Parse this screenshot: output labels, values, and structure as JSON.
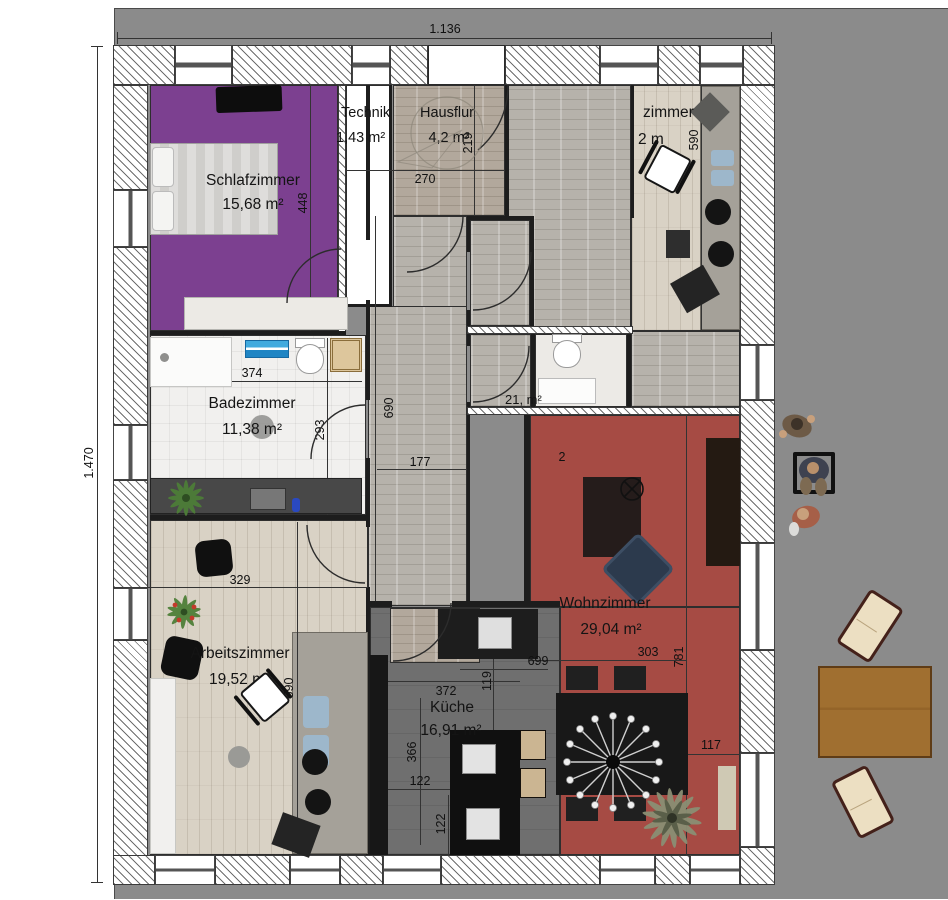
{
  "meta": {
    "width_label": "1.136",
    "height_label": "1.470"
  },
  "palette": {
    "bedroom_purple": "#7c4090",
    "living_red": "#a64b44",
    "outdoor_gray": "#8b8b8b",
    "wood_light": "#d9d2c5",
    "stone_gray": "#b6b2ab",
    "kitchen_floor": "#6f6f6f",
    "counter_black": "#161616",
    "chair_blue": "#9db7cb",
    "outdoor_table_brown": "#9c6b2e"
  },
  "icons": {
    "ceiling_lamp": "circle-with-x",
    "chandelier": "starburst-lamp"
  },
  "rooms": {
    "schlafzimmer": {
      "name": "Schlafzimmer",
      "area": "15,68 m²",
      "height_dim": "448"
    },
    "technik": {
      "name": "Technik",
      "area": "1,43 m²"
    },
    "hausflur": {
      "name": "Hausflur",
      "area": "4,2 m²",
      "width_dim": "270",
      "height_dim": "219"
    },
    "zimmer": {
      "name": "zimmer",
      "area": "2 m",
      "height_dim": "590"
    },
    "badezimmer": {
      "name": "Badezimmer",
      "area": "11,38 m²",
      "width_dim": "374",
      "height_dim": "293"
    },
    "flur": {
      "height_dim": "690",
      "width_dim": "177"
    },
    "wc": {
      "area_fragment": "21, m²"
    },
    "wohnzimmer": {
      "name": "Wohnzimmer",
      "area": "29,04 m²",
      "height_dim": "781",
      "dim_303": "303",
      "dim_699": "699",
      "dim_117": "117",
      "stray_mark": "2"
    },
    "kueche": {
      "name": "Küche",
      "area": "16,91 m²",
      "width_dim": "372",
      "dim_119": "119",
      "height_dim": "366",
      "dim_122a": "122",
      "dim_122b": "122"
    },
    "arbeitszimmer": {
      "name": "Arbeitszimmer",
      "area": "19,52 m",
      "width_dim": "329",
      "height_dim": "590"
    }
  }
}
